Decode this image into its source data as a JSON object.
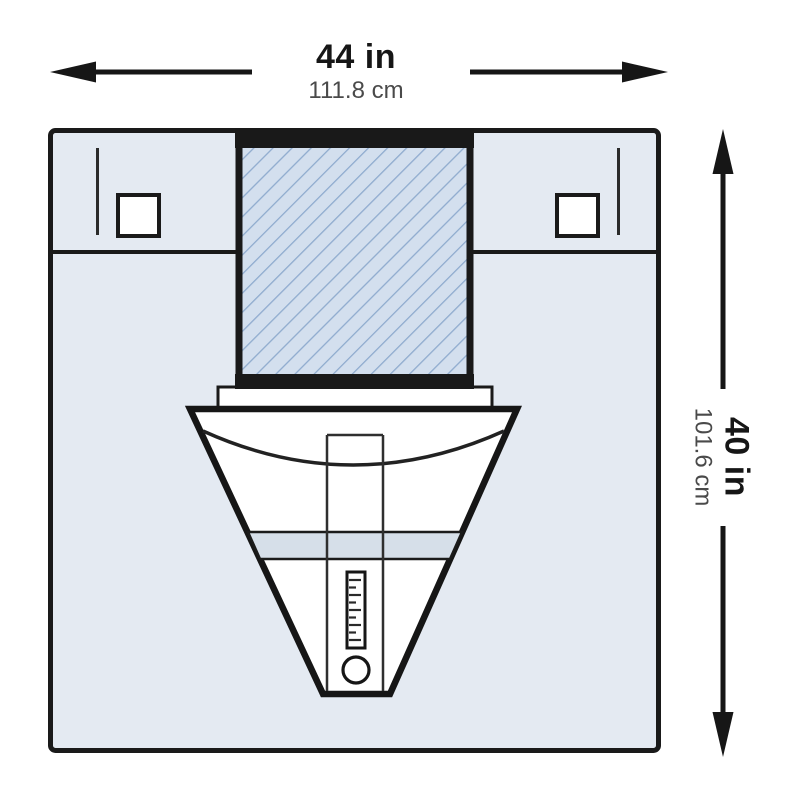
{
  "dimensions": {
    "width": {
      "imperial": "44 in",
      "metric": "111.8 cm"
    },
    "height": {
      "imperial": "40 in",
      "metric": "101.6 cm"
    }
  },
  "colors": {
    "outline": "#1a1a1a",
    "drape_fill": "#e4eaf2",
    "reinforcement_fill": "#d3dfee",
    "reinforcement_hatch_line": "#8fabce",
    "pouch_band_fill": "#d6dfe9",
    "pouch_fill": "#ffffff",
    "metric_text": "#4a4a4a"
  }
}
